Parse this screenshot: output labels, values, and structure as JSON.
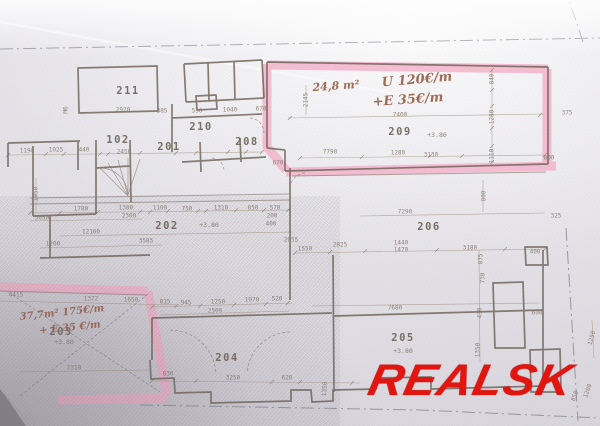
{
  "watermark": {
    "text": "REALSK",
    "color": "#e4140e"
  },
  "plan": {
    "rooms": [
      {
        "num": "211",
        "x": 128,
        "y": 91
      },
      {
        "num": "102",
        "x": 118,
        "y": 140
      },
      {
        "num": "201",
        "x": 169,
        "y": 147
      },
      {
        "num": "210",
        "x": 201,
        "y": 127
      },
      {
        "num": "208",
        "x": 247,
        "y": 142
      },
      {
        "num": "202",
        "x": 167,
        "y": 226,
        "elev": "+3.80",
        "ex": 209,
        "ey": 225
      },
      {
        "num": "209",
        "x": 400,
        "y": 132,
        "elev": "+3.80",
        "ex": 437,
        "ey": 135
      },
      {
        "num": "206",
        "x": 429,
        "y": 227
      },
      {
        "num": "203",
        "x": 61,
        "y": 332,
        "elev": "+3.80",
        "ex": 64,
        "ey": 342
      },
      {
        "num": "204",
        "x": 227,
        "y": 358
      },
      {
        "num": "205",
        "x": 403,
        "y": 338,
        "elev": "+3.80",
        "ex": 403,
        "ey": 351
      }
    ],
    "annotations": [
      {
        "text": "24,8 m²",
        "x": 336,
        "y": 86,
        "size": 11,
        "rot": -4
      },
      {
        "text": "U 120€/m",
        "x": 417,
        "y": 80,
        "size": 13,
        "rot": -5
      },
      {
        "text": "+E  35€/m",
        "x": 408,
        "y": 100,
        "size": 13,
        "rot": -4
      },
      {
        "text": "37,7m² 175€/m",
        "x": 62,
        "y": 313,
        "size": 10,
        "rot": -6
      },
      {
        "text": "+ E 35 €/m",
        "x": 70,
        "y": 328,
        "size": 10,
        "rot": -6
      }
    ],
    "dimensions": [
      {
        "t": "2920",
        "x": 123,
        "y": 110
      },
      {
        "t": "385",
        "x": 162,
        "y": 111
      },
      {
        "t": "530",
        "x": 197,
        "y": 111
      },
      {
        "t": "1040",
        "x": 230,
        "y": 110
      },
      {
        "t": "670",
        "x": 261,
        "y": 109
      },
      {
        "t": "M6",
        "x": 66,
        "y": 110,
        "r": -90
      },
      {
        "t": "7400",
        "x": 400,
        "y": 115
      },
      {
        "t": "2145",
        "x": 306,
        "y": 100,
        "r": -90
      },
      {
        "t": "840",
        "x": 492,
        "y": 79,
        "r": -90
      },
      {
        "t": "1280",
        "x": 492,
        "y": 117,
        "r": -90
      },
      {
        "t": "1110",
        "x": 492,
        "y": 156,
        "r": -90
      },
      {
        "t": "375",
        "x": 567,
        "y": 113
      },
      {
        "t": "800",
        "x": 549,
        "y": 158
      },
      {
        "t": "1190",
        "x": 27,
        "y": 151
      },
      {
        "t": "1025",
        "x": 56,
        "y": 150
      },
      {
        "t": "440",
        "x": 84,
        "y": 150
      },
      {
        "t": "2450",
        "x": 124,
        "y": 152
      },
      {
        "t": "7790",
        "x": 330,
        "y": 152
      },
      {
        "t": "1280",
        "x": 398,
        "y": 153
      },
      {
        "t": "3130",
        "x": 431,
        "y": 155
      },
      {
        "t": "670",
        "x": 278,
        "y": 163
      },
      {
        "t": "325",
        "x": 556,
        "y": 216
      },
      {
        "t": "1050",
        "x": 36,
        "y": 194,
        "r": -90
      },
      {
        "t": "3050",
        "x": 42,
        "y": 218
      },
      {
        "t": "1780",
        "x": 81,
        "y": 209
      },
      {
        "t": "1300",
        "x": 126,
        "y": 208
      },
      {
        "t": "2300",
        "x": 129,
        "y": 216
      },
      {
        "t": "1100",
        "x": 160,
        "y": 208
      },
      {
        "t": "750",
        "x": 187,
        "y": 209
      },
      {
        "t": "1310",
        "x": 221,
        "y": 208
      },
      {
        "t": "850",
        "x": 253,
        "y": 208
      },
      {
        "t": "570",
        "x": 275,
        "y": 208
      },
      {
        "t": "200",
        "x": 272,
        "y": 216
      },
      {
        "t": "400",
        "x": 271,
        "y": 224
      },
      {
        "t": "12160",
        "x": 91,
        "y": 232
      },
      {
        "t": "1200",
        "x": 53,
        "y": 244
      },
      {
        "t": "3585",
        "x": 146,
        "y": 241
      },
      {
        "t": "2055",
        "x": 291,
        "y": 240
      },
      {
        "t": "7290",
        "x": 405,
        "y": 212
      },
      {
        "t": "1550",
        "x": 305,
        "y": 249
      },
      {
        "t": "2825",
        "x": 340,
        "y": 245
      },
      {
        "t": "1440",
        "x": 401,
        "y": 243
      },
      {
        "t": "1470",
        "x": 401,
        "y": 250
      },
      {
        "t": "3180",
        "x": 470,
        "y": 248
      },
      {
        "t": "400",
        "x": 535,
        "y": 252
      },
      {
        "t": "875",
        "x": 481,
        "y": 259,
        "r": -90
      },
      {
        "t": "730",
        "x": 483,
        "y": 278,
        "r": -90
      },
      {
        "t": "800",
        "x": 484,
        "y": 196,
        "r": -90
      },
      {
        "t": "430",
        "x": 480,
        "y": 313,
        "r": -90
      },
      {
        "t": "1350",
        "x": 478,
        "y": 350,
        "r": -90
      },
      {
        "t": "600",
        "x": 537,
        "y": 313
      },
      {
        "t": "7680",
        "x": 395,
        "y": 308
      },
      {
        "t": "4415",
        "x": 16,
        "y": 295
      },
      {
        "t": "1372",
        "x": 91,
        "y": 299
      },
      {
        "t": "1650",
        "x": 131,
        "y": 300
      },
      {
        "t": "815",
        "x": 165,
        "y": 302
      },
      {
        "t": "7310",
        "x": 74,
        "y": 368
      },
      {
        "t": "945",
        "x": 186,
        "y": 303
      },
      {
        "t": "1250",
        "x": 218,
        "y": 302
      },
      {
        "t": "1070",
        "x": 252,
        "y": 300
      },
      {
        "t": "520",
        "x": 277,
        "y": 299
      },
      {
        "t": "2500",
        "x": 215,
        "y": 311
      },
      {
        "t": "830",
        "x": 168,
        "y": 374
      },
      {
        "t": "3250",
        "x": 233,
        "y": 378
      },
      {
        "t": "620",
        "x": 287,
        "y": 378
      },
      {
        "t": "1350",
        "x": 325,
        "y": 389,
        "r": -85
      },
      {
        "t": "1250",
        "x": 592,
        "y": 338,
        "r": -75
      },
      {
        "t": "1200",
        "x": 588,
        "y": 391,
        "r": -70
      },
      {
        "t": "850",
        "x": 575,
        "y": 396,
        "r": -70
      }
    ]
  }
}
